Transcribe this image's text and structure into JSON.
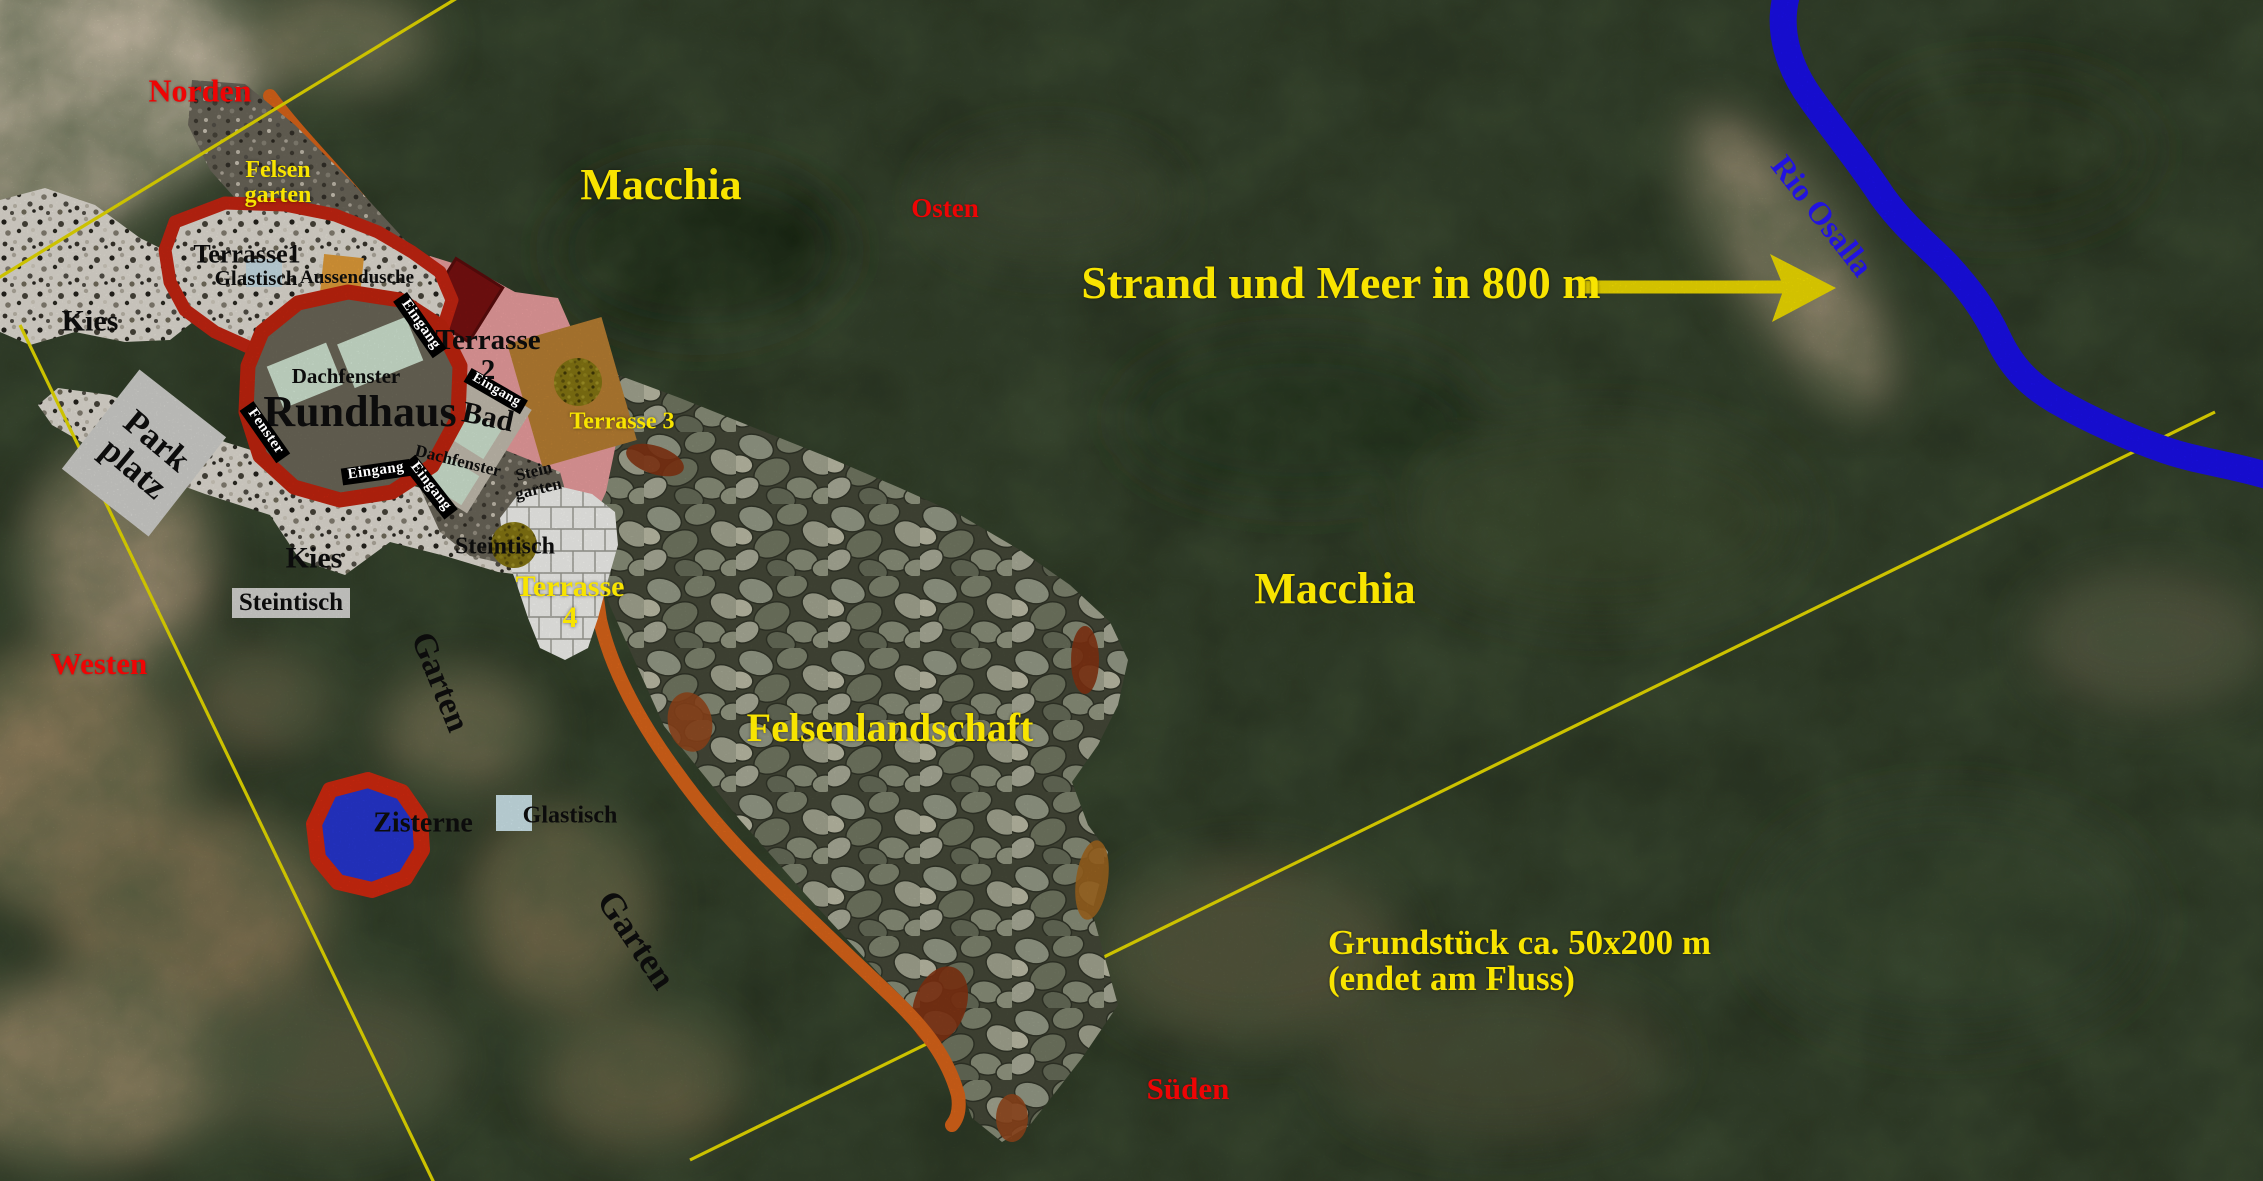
{
  "map": {
    "compass": {
      "norden": "Norden",
      "osten": "Osten",
      "sueden": "Süden",
      "westen": "Westen"
    },
    "notes": {
      "strand": "Strand und Meer in 800 m",
      "grundstueck_line1": "Grundstück ca. 50x200 m",
      "grundstueck_line2": "(endet am Fluss)"
    },
    "river": {
      "name": "Rio Osalla"
    },
    "vegetation": {
      "macchia_north": "Macchia",
      "macchia_center": "Macchia"
    },
    "areas": {
      "felsengarten_line1": "Felsen",
      "felsengarten_line2": "garten",
      "felsenlandschaft": "Felsenlandschaft",
      "garten_west": "Garten",
      "garten_sued": "Garten",
      "kies_nord": "Kies",
      "kies_sued": "Kies",
      "parkplatz_line1": "Park",
      "parkplatz_line2": "platz",
      "steingarten_line1": "Stein",
      "steingarten_line2": "garten",
      "terrasse1": "Terrasse1",
      "terrasse2_line1": "Terrasse",
      "terrasse2_line2": "2",
      "terrasse3": "Terrasse 3",
      "terrasse4_line1": "Terrasse",
      "terrasse4_line2": "4",
      "zisterne": "Zisterne"
    },
    "furniture": {
      "glastisch_terrasse1": "Glastisch",
      "glastisch_garten": "Glastisch",
      "steintisch_kies": "Steintisch",
      "steintisch_terrasse4": "Steintisch",
      "aussendusche": "Aussendusche"
    },
    "house": {
      "name": "Rundhaus",
      "dachfenster_haus": "Dachfenster",
      "dachfenster_bad": "Dachfenster",
      "bad": "Bad",
      "eingang_top": "Eingang",
      "eingang_bottom": "Eingang",
      "eingang_lower": "Eingang",
      "eingang_bad": "Eingang",
      "fenster": "Fenster"
    },
    "colors": {
      "boundary_yellow": "#f0e400",
      "path_orange": "#e2681a",
      "river_blue": "#1b10f2",
      "outline_red": "#cc2612",
      "terrace_pink": "#f2a3a4",
      "house_roof": "#6f6b5b",
      "skylight_green": "#d7ecd9",
      "cistern_blue": "#2838d8",
      "terrasse3_brown": "#bf8334",
      "label_red": "#ee0404",
      "label_yellow": "#f8e400"
    }
  }
}
